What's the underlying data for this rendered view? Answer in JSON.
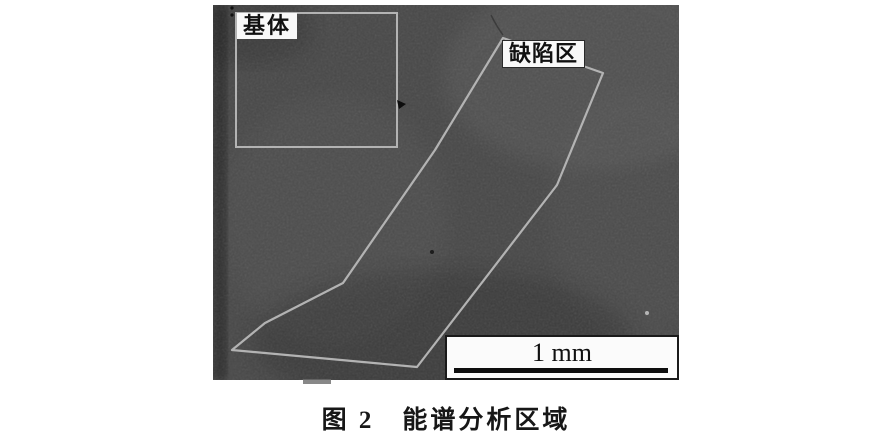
{
  "figure": {
    "caption": "图 2　能谱分析区域",
    "labels": {
      "matrix": "基体",
      "defect": "缺陷区"
    },
    "scale_bar": {
      "label": "1 mm"
    },
    "colors": {
      "page_bg": "#ffffff",
      "photo_base": "#474747",
      "outline": "#b3b3b3",
      "label_bg": "#f8f8f8",
      "label_fg": "#111111",
      "scalebar_bg": "#fbfbfb",
      "scalebar_border": "#1a1a1a",
      "caption_fg": "#171717"
    },
    "micrograph": {
      "defect_polygon_points": "290,33 390,68 344,180 204,362 19,345 52,318 130,278 222,145",
      "matrix_rect": {
        "x": 23,
        "y": 8,
        "width": 161,
        "height": 134
      }
    }
  }
}
